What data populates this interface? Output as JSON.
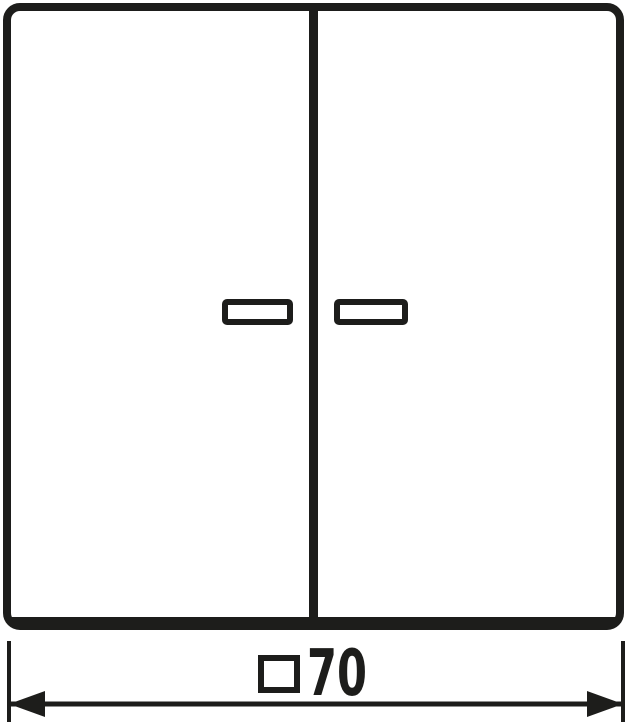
{
  "drawing": {
    "type": "technical-dimension-drawing",
    "subject": "two-gang rocker switch with lens windows"
  },
  "dimension": {
    "symbol": "□",
    "symbol_name": "square-dimension-icon",
    "value": "70",
    "full_label": "□70"
  },
  "colors": {
    "stroke": "#1d1d1b",
    "background": "#ffffff"
  }
}
